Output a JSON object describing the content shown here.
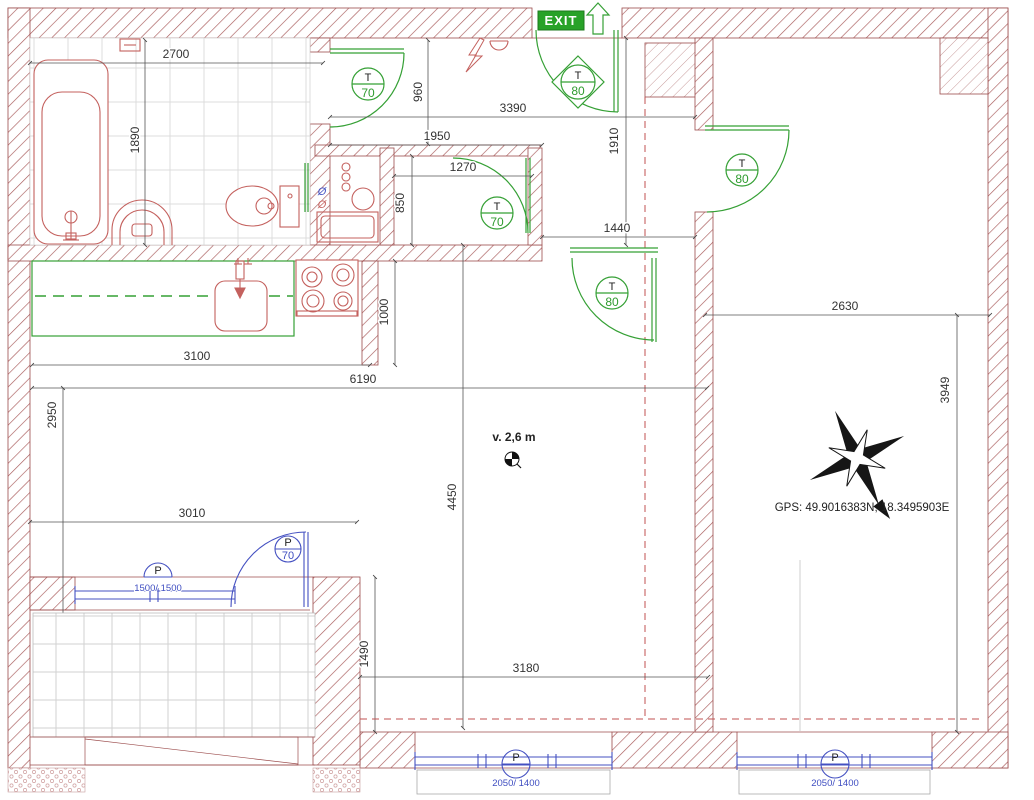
{
  "annotations": {
    "exit_label": "EXIT",
    "gps_label": "GPS: 49.9016383N, 18.3495903E",
    "ceiling_height_label": "v. 2,6 m"
  },
  "door_labels": {
    "bathroom_door": {
      "letter": "T",
      "number": "70"
    },
    "small_room_door": {
      "letter": "T",
      "number": "70"
    },
    "entrance_door": {
      "letter": "T",
      "number": "80"
    },
    "living_room_door": {
      "letter": "T",
      "number": "80"
    },
    "right_room_door": {
      "letter": "T",
      "number": "80"
    },
    "balcony_door": {
      "letter": "P",
      "number": "70"
    }
  },
  "window_labels": {
    "balcony_window": {
      "letter": "P",
      "size": "1500/ 1500"
    },
    "bottom_left_window": {
      "letter": "P",
      "size": "2050/ 1400"
    },
    "bottom_right_window": {
      "letter": "P",
      "size": "2050/ 1400"
    }
  },
  "dimensions_mm": {
    "bathroom_width": "2700",
    "bathroom_depth": "1890",
    "bathroom_door_height": "960",
    "hall_width": "3390",
    "hall_left_width": "1950",
    "small_room_width": "1270",
    "small_room_depth": "850",
    "entry_depth": "1910",
    "hall_opening_width": "1440",
    "kitchen_column_depth": "1000",
    "kitchen_width": "3100",
    "living_total_width": "6190",
    "living_left_depth": "2950",
    "living_depth": "4450",
    "balcony_front_width": "3010",
    "balcony_side_depth": "1490",
    "living_bottom_width": "3180",
    "right_room_width": "2630",
    "right_room_depth": "3949"
  },
  "tech_room": {
    "diameter_mark_supply": "Ø",
    "diameter_mark_waste": "Ø"
  },
  "colors": {
    "wall_hatch": "#a85a5a",
    "fixture_red": "#c4615e",
    "symbol_green": "#35a035",
    "exit_green": "#28a228",
    "window_blue": "#4450c1",
    "dimension_text": "#333333",
    "dashed_red": "#c05050"
  }
}
